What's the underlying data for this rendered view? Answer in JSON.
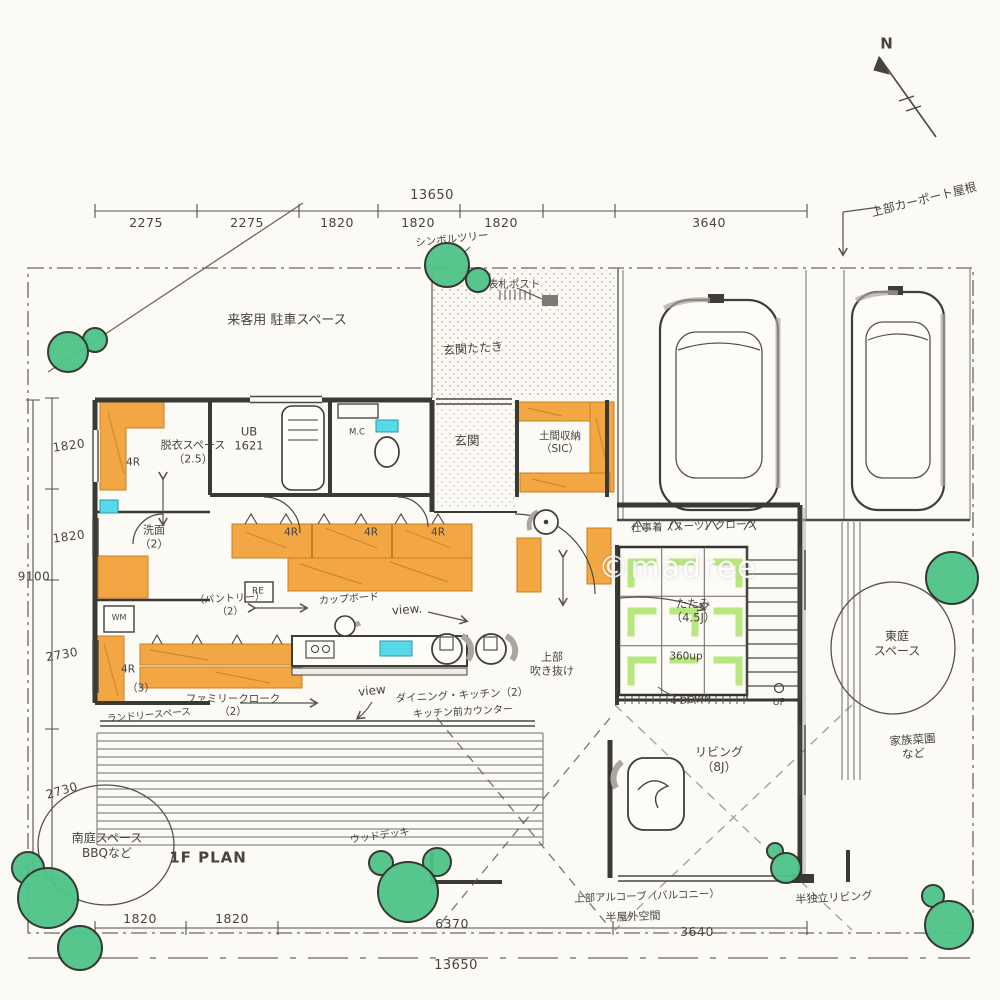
{
  "colors": {
    "paper": "#fbfaf4",
    "ink": "#46443d",
    "wall": "#3b3934",
    "dimline": "#55524c",
    "orange": "#f3a744",
    "orangeEdge": "#c97f1e",
    "tree": "#4ec488",
    "treeEdge": "#2c6e4c",
    "tatamiMark": "#b9e77f",
    "cyan": "#56d9e8",
    "gray": "#a9a79f"
  },
  "annotations": [
    {
      "id": "north",
      "text": "N",
      "x": 887,
      "y": 44,
      "s": 15,
      "cls": "title"
    },
    {
      "id": "dim-top-total",
      "text": "13650",
      "x": 432,
      "y": 196,
      "s": 13,
      "cls": "dim"
    },
    {
      "id": "dim-top-1",
      "text": "2275",
      "x": 146,
      "y": 223,
      "s": 12.5,
      "cls": "dim"
    },
    {
      "id": "dim-top-2",
      "text": "2275",
      "x": 247,
      "y": 223,
      "s": 12.5,
      "cls": "dim"
    },
    {
      "id": "dim-top-3",
      "text": "1820",
      "x": 337,
      "y": 223,
      "s": 12.5,
      "cls": "dim"
    },
    {
      "id": "dim-top-4",
      "text": "1820",
      "x": 418,
      "y": 223,
      "s": 12.5,
      "cls": "dim"
    },
    {
      "id": "dim-top-5",
      "text": "1820",
      "x": 501,
      "y": 223,
      "s": 12.5,
      "cls": "dim"
    },
    {
      "id": "dim-top-6",
      "text": "3640",
      "x": 709,
      "y": 223,
      "s": 12.5,
      "cls": "dim"
    },
    {
      "id": "dim-left-1",
      "text": "1820",
      "x": 69,
      "y": 446,
      "s": 12,
      "r": -8,
      "cls": "dim"
    },
    {
      "id": "dim-left-2",
      "text": "1820",
      "x": 69,
      "y": 537,
      "s": 12,
      "r": -8,
      "cls": "dim"
    },
    {
      "id": "dim-left-total",
      "text": "9100",
      "x": 34,
      "y": 577,
      "s": 12,
      "cls": "dim"
    },
    {
      "id": "dim-left-3",
      "text": "2730",
      "x": 62,
      "y": 655,
      "s": 12,
      "r": -10,
      "cls": "dim"
    },
    {
      "id": "dim-left-4",
      "text": "2730",
      "x": 62,
      "y": 791,
      "s": 12,
      "r": -16,
      "cls": "dim"
    },
    {
      "id": "dim-bot-1",
      "text": "1820",
      "x": 140,
      "y": 919,
      "s": 12.5,
      "cls": "dim"
    },
    {
      "id": "dim-bot-2",
      "text": "1820",
      "x": 232,
      "y": 919,
      "s": 12.5,
      "cls": "dim"
    },
    {
      "id": "dim-bot-3",
      "text": "6370",
      "x": 452,
      "y": 924,
      "s": 12.5,
      "cls": "dim"
    },
    {
      "id": "dim-bot-4",
      "text": "3640",
      "x": 697,
      "y": 932,
      "s": 12.5,
      "cls": "dim"
    },
    {
      "id": "dim-bot-total",
      "text": "13650",
      "x": 456,
      "y": 966,
      "s": 13,
      "cls": "dim"
    },
    {
      "id": "carport-roof",
      "text": "上部カーポート屋根",
      "x": 924,
      "y": 200,
      "s": 12,
      "r": -14
    },
    {
      "id": "symbol-tree",
      "text": "シンボルツリー",
      "x": 452,
      "y": 240,
      "s": 10.5,
      "r": -6
    },
    {
      "id": "nameplate-post",
      "text": "表札ポスト",
      "x": 514,
      "y": 285,
      "s": 10.5
    },
    {
      "id": "visitor-parking",
      "text": "来客用 駐車スペース",
      "x": 287,
      "y": 321,
      "s": 13
    },
    {
      "id": "genkan-tataki",
      "text": "玄関たたき",
      "x": 473,
      "y": 349,
      "s": 12,
      "r": -4
    },
    {
      "id": "genkan",
      "text": "玄関",
      "x": 467,
      "y": 441,
      "s": 12.5
    },
    {
      "id": "doma-storage",
      "text": "土間収納\n（SIC）",
      "x": 560,
      "y": 443,
      "s": 10.5
    },
    {
      "id": "unit-bath",
      "text": "UB\n1621",
      "x": 249,
      "y": 439,
      "s": 11.5
    },
    {
      "id": "mc",
      "text": "M.C",
      "x": 357,
      "y": 433,
      "s": 8.5
    },
    {
      "id": "datsui-space",
      "text": "脱衣スペース\n（2.5）",
      "x": 193,
      "y": 452,
      "s": 11
    },
    {
      "id": "shelf-4r-1",
      "text": "4R",
      "x": 133,
      "y": 463,
      "s": 10.5
    },
    {
      "id": "senmen",
      "text": "洗面\n（2）",
      "x": 154,
      "y": 537,
      "s": 11
    },
    {
      "id": "wm",
      "text": "WM",
      "x": 119,
      "y": 618,
      "s": 8
    },
    {
      "id": "shelf-4r-2",
      "text": "4R",
      "x": 128,
      "y": 670,
      "s": 10.5
    },
    {
      "id": "laundry-3",
      "text": "（3）",
      "x": 141,
      "y": 689,
      "s": 10.5
    },
    {
      "id": "laundry-space",
      "text": "ランドリースペース",
      "x": 149,
      "y": 716,
      "s": 9.5,
      "r": -5
    },
    {
      "id": "pantry",
      "text": "（パントリー）\n（2）",
      "x": 230,
      "y": 606,
      "s": 10,
      "r": -3
    },
    {
      "id": "re",
      "text": "RE",
      "x": 258,
      "y": 592,
      "s": 9
    },
    {
      "id": "cupboard",
      "text": "カップボード",
      "x": 349,
      "y": 600,
      "s": 10,
      "r": -4
    },
    {
      "id": "shelf-4r-3",
      "text": "4R",
      "x": 291,
      "y": 533,
      "s": 10.5
    },
    {
      "id": "shelf-4r-4",
      "text": "4R",
      "x": 371,
      "y": 533,
      "s": 10.5
    },
    {
      "id": "shelf-4r-5",
      "text": "4R",
      "x": 438,
      "y": 533,
      "s": 10.5
    },
    {
      "id": "view-1",
      "text": "view.",
      "x": 407,
      "y": 610,
      "s": 12,
      "r": -4
    },
    {
      "id": "view-2",
      "text": "view",
      "x": 372,
      "y": 691,
      "s": 12,
      "r": -6
    },
    {
      "id": "dining-kitchen",
      "text": "ダイニング・キッチン（2）",
      "x": 462,
      "y": 696,
      "s": 10.5,
      "r": -3
    },
    {
      "id": "kitchen-counter",
      "text": "キッチン前カウンター",
      "x": 463,
      "y": 713,
      "s": 10,
      "r": -3
    },
    {
      "id": "family-cloak",
      "text": "ファミリークローク\n（2）",
      "x": 233,
      "y": 706,
      "s": 10.5
    },
    {
      "id": "work-cloak",
      "text": "仕事着（スーツ）クローク",
      "x": 694,
      "y": 527,
      "s": 10.5,
      "r": -2
    },
    {
      "id": "tatami",
      "text": "たたみ\n（4.5J）",
      "x": 693,
      "y": 611,
      "s": 11.5
    },
    {
      "id": "tatami-360up",
      "text": "360up",
      "x": 686,
      "y": 657,
      "s": 10.5
    },
    {
      "id": "tatami-step",
      "text": "4-DOWN",
      "x": 691,
      "y": 701,
      "s": 9.5,
      "r": -4
    },
    {
      "id": "void-above",
      "text": "上部\n吹き抜け",
      "x": 552,
      "y": 664,
      "s": 11
    },
    {
      "id": "living",
      "text": "リビング\n（8J）",
      "x": 719,
      "y": 760,
      "s": 12
    },
    {
      "id": "stairs-up",
      "text": "UP",
      "x": 779,
      "y": 703,
      "s": 9.5
    },
    {
      "id": "east-garden",
      "text": "東庭\nスペース",
      "x": 897,
      "y": 644,
      "s": 12
    },
    {
      "id": "family-garden",
      "text": "家族菜園\nなど",
      "x": 913,
      "y": 747,
      "s": 11.5,
      "r": -4
    },
    {
      "id": "south-garden",
      "text": "南庭スペース\nBBQなど",
      "x": 107,
      "y": 846,
      "s": 12
    },
    {
      "id": "plan-title",
      "text": "1F PLAN",
      "x": 208,
      "y": 858,
      "s": 15,
      "cls": "title"
    },
    {
      "id": "wood-deck",
      "text": "ウッドデッキ",
      "x": 380,
      "y": 837,
      "s": 10,
      "r": -8
    },
    {
      "id": "balcony-above",
      "text": "上部アルコーブ（バルコニー）",
      "x": 647,
      "y": 897,
      "s": 10.5,
      "r": -2
    },
    {
      "id": "semi-outdoor",
      "text": "半屋外空間",
      "x": 633,
      "y": 917,
      "s": 11,
      "r": -2
    },
    {
      "id": "semi-living",
      "text": "半独立リビング",
      "x": 834,
      "y": 898,
      "s": 11,
      "r": -3
    },
    {
      "id": "watermark",
      "text": "©madree",
      "x": 678,
      "y": 568,
      "s": 30,
      "cls": "watermark"
    }
  ]
}
